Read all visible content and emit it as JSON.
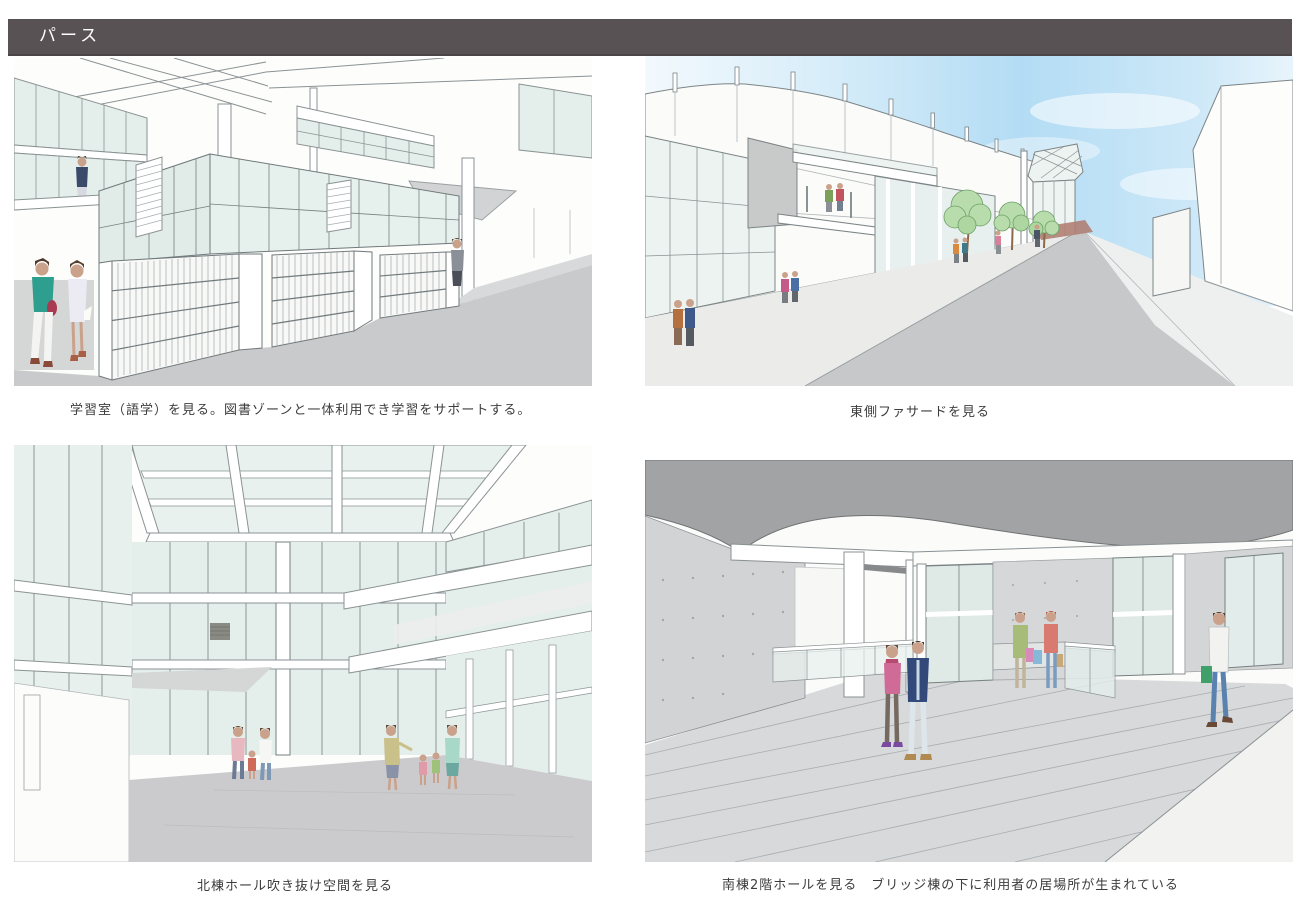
{
  "header": {
    "title": "パース",
    "bar_color": "#585254",
    "text_color": "#ffffff"
  },
  "figures": [
    {
      "name": "study-room-perspective",
      "caption": "学習室（語学）を見る。図書ゾーンと一体利用でき学習をサポートする。"
    },
    {
      "name": "east-facade-perspective",
      "caption": "東側ファサードを見る"
    },
    {
      "name": "north-hall-atrium-perspective",
      "caption": "北棟ホール吹き抜け空間を見る"
    },
    {
      "name": "south-hall-2f-perspective",
      "caption": "南棟2階ホールを見る　ブリッジ棟の下に利用者の居場所が生まれている"
    }
  ],
  "palette": {
    "glass_green": "#e4efeb",
    "floor_gray": "#cbcbcd",
    "road_gray": "#c6c8c9",
    "sky_blue": "#b3dcf4",
    "tree_green": "#b5dcab",
    "bridge_ceiling_gray": "#a2a3a5",
    "concrete_gray": "#d2d3d4",
    "sketch_line": "#8b9294",
    "accent_paving_red": "#b08073"
  }
}
